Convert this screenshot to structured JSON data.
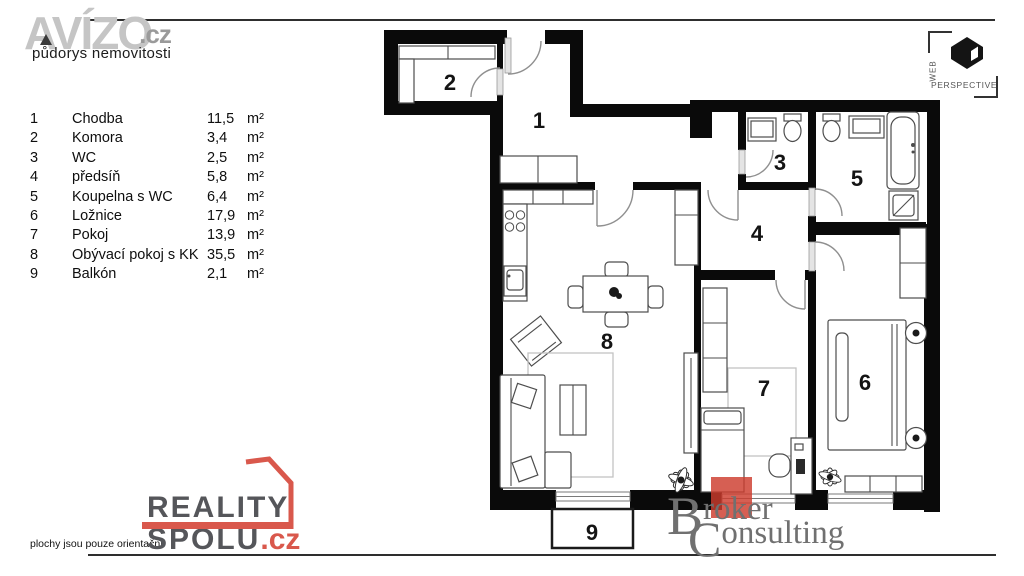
{
  "header": {
    "avizo": {
      "brand": "AVÍZO",
      "tld": ".cz",
      "subtitle": "půdorys nemovitosti"
    },
    "webperspective": {
      "word_vertical": "WEB",
      "word_horizontal": "PERSPECTIVE"
    }
  },
  "legend": {
    "rows": [
      {
        "num": "1",
        "name": "Chodba",
        "area": "11,5",
        "unit": "m²"
      },
      {
        "num": "2",
        "name": "Komora",
        "area": "3,4",
        "unit": "m²"
      },
      {
        "num": "3",
        "name": "WC",
        "area": "2,5",
        "unit": "m²"
      },
      {
        "num": "4",
        "name": "předsíň",
        "area": "5,8",
        "unit": "m²"
      },
      {
        "num": "5",
        "name": "Koupelna s WC",
        "area": "6,4",
        "unit": "m²"
      },
      {
        "num": "6",
        "name": "Ložnice",
        "area": "17,9",
        "unit": "m²"
      },
      {
        "num": "7",
        "name": "Pokoj",
        "area": "13,9",
        "unit": "m²"
      },
      {
        "num": "8",
        "name": "Obývací pokoj s KK",
        "area": "35,5",
        "unit": "m²"
      },
      {
        "num": "9",
        "name": "Balkón",
        "area": "2,1",
        "unit": "m²"
      }
    ]
  },
  "footer": {
    "disclaimer": "plochy jsou pouze orientační",
    "realityspolu": {
      "word1": "REALITY",
      "word2": "SPOLU",
      "tld": ".cz"
    },
    "broker": {
      "initial1": "B",
      "rest1": "roker",
      "initial2": "C",
      "rest2": "onsulting"
    }
  },
  "colors": {
    "wall": "#0a0a0a",
    "accent_red": "#cd3c2d",
    "logo_red": "#d9584c",
    "brand_gray": "#c5c5c5",
    "broker_gray": "#707070"
  }
}
